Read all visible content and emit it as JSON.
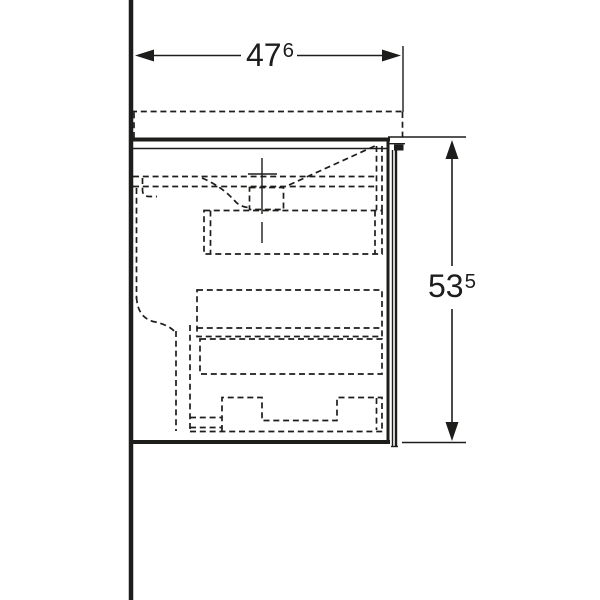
{
  "colors": {
    "line": "#1d1d1b",
    "background": "#ffffff"
  },
  "dimensions": {
    "width": {
      "value": "47",
      "superscript": "6"
    },
    "height": {
      "value": "53",
      "superscript": "5"
    }
  }
}
